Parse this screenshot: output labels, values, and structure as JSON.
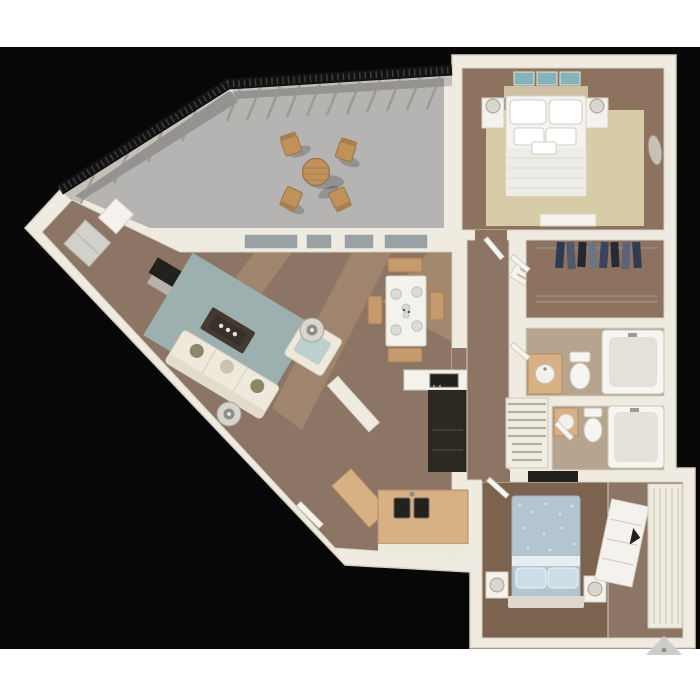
{
  "scene": {
    "type": "3d-floor-plan-rendering",
    "subject": "top-down 3D rendering of a two-bedroom, two-bathroom apartment with a large balcony",
    "text_visible": "none"
  },
  "colors": {
    "page_bg": "#ffffff",
    "photo_bg": "#070707",
    "wall": "#efebe0",
    "wall_shade": "#d6d0c2",
    "wood": "#8d7565",
    "wood_red": "#8e7260",
    "wood_light": "#c9ab84",
    "wood_dark": "#7b6350",
    "balcony_floor": "#b5b4b2",
    "railing": "#121212",
    "rug_living": "#9cb0b0",
    "rug_bedroom": "#d8cba8",
    "sofa": "#efe9dc",
    "pillow_olive": "#8b8768",
    "dark_table": "#443930",
    "tv": "#22211e",
    "white_furniture": "#f4f2ec",
    "glass": "#99a1a5",
    "counter_tan": "#d7b083",
    "counter_edge": "#b08c5f",
    "cabinet_dark": "#2c2822",
    "sink_dark": "#23211e",
    "bed_white": "#f4f3ef",
    "bed_blue": "#b3c5d1",
    "bed_blue_light": "#cfdde6",
    "teal_art": "#83b4ba",
    "bath_floor": "#b7a48f",
    "fixture": "#f6f5f1",
    "chair_tan": "#c59a6c",
    "lamp_gray": "#d8d5cd",
    "metal_gray": "#9a9a97",
    "appliance_gray": "#d2d0cb",
    "door_leaf": "#f7f5ef",
    "marker_gray": "#cdccca",
    "clothes_navy": "#2d3a55",
    "clothes_slate": "#51586b",
    "clothes_charcoal": "#23272f",
    "clothes_gray": "#6d7585"
  },
  "rooms": [
    {
      "id": "balcony",
      "furniture": [
        "round-patio-table",
        "patio-chair",
        "patio-chair",
        "patio-chair",
        "patio-chair",
        "metal-railing"
      ]
    },
    {
      "id": "bedroom-1",
      "furniture": [
        "bed",
        "pillows",
        "nightstand",
        "nightstand",
        "table-lamp",
        "table-lamp",
        "area-rug",
        "teal-wall-art",
        "bench",
        "oval-mirror"
      ]
    },
    {
      "id": "walk-in-closet",
      "furniture": [
        "closet-rod",
        "hanging-clothes",
        "lower-rod"
      ]
    },
    {
      "id": "bathroom-1",
      "furniture": [
        "vanity-sink",
        "toilet",
        "bathtub"
      ]
    },
    {
      "id": "bathroom-2",
      "furniture": [
        "vanity-sink",
        "toilet",
        "bathtub"
      ]
    },
    {
      "id": "hallway",
      "furniture": [
        "console-table",
        "staircase"
      ]
    },
    {
      "id": "living-room",
      "furniture": [
        "sofa",
        "armchair",
        "coffee-table",
        "area-rug",
        "tv",
        "media-console",
        "side-table-lamp",
        "side-table-lamp"
      ]
    },
    {
      "id": "dining-area",
      "furniture": [
        "dining-table",
        "place-settings",
        "bench",
        "bench",
        "chair",
        "chair",
        "sliding-glass-doors"
      ]
    },
    {
      "id": "kitchen",
      "furniture": [
        "double-sink",
        "cooktop",
        "dark-cabinet-run",
        "tan-counter",
        "angled-cabinet"
      ]
    },
    {
      "id": "entry-wing",
      "furniture": [
        "entry-door",
        "appliance-cabinet",
        "storage-box"
      ]
    },
    {
      "id": "bedroom-2",
      "furniture": [
        "bed",
        "blue-patterned-duvet",
        "pillows",
        "nightstand",
        "nightstand",
        "table-lamp",
        "table-lamp",
        "dresser",
        "wardrobe",
        "tv"
      ]
    }
  ],
  "watermark": {
    "shape": "gray-triangle-arrow",
    "position": "bottom-right"
  }
}
